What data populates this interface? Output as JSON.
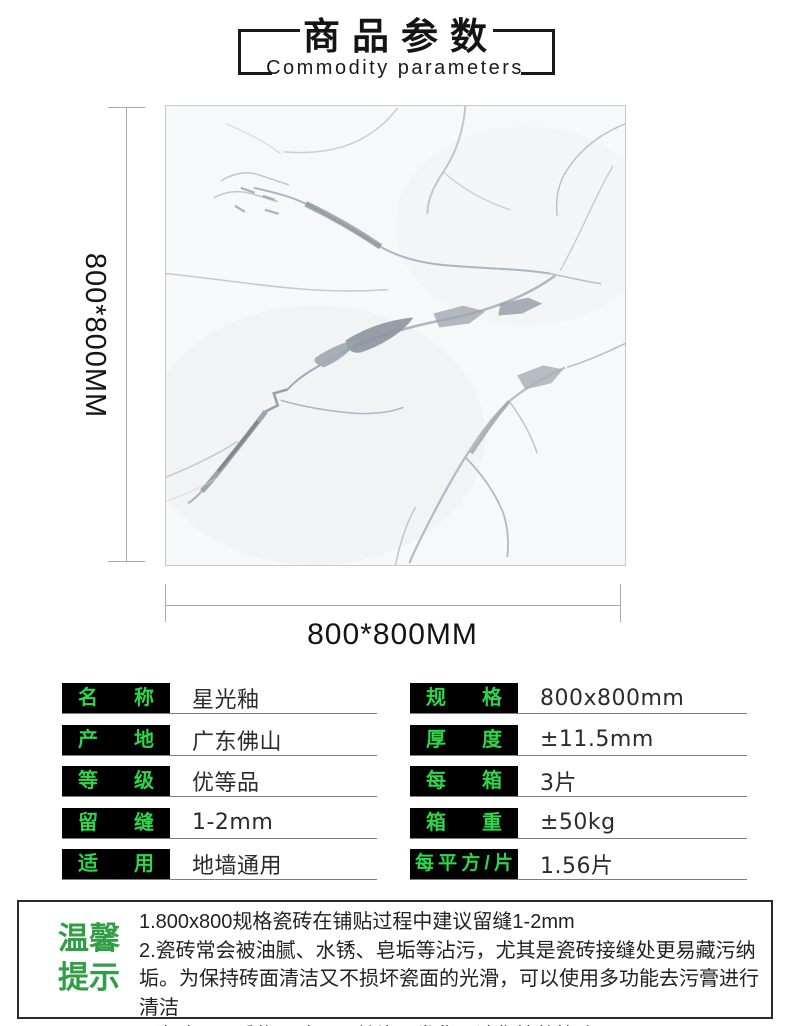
{
  "header": {
    "title": "商品参数",
    "subtitle": "Commodity parameters"
  },
  "figure": {
    "vertical_dimension": "800*800MM",
    "horizontal_dimension": "800*800MM",
    "tile_description": "white marble tile with gray veins"
  },
  "specs": {
    "left": [
      {
        "label": "名 称",
        "value": "星光釉"
      },
      {
        "label": "产 地",
        "value": "广东佛山"
      },
      {
        "label": "等 级",
        "value": "优等品"
      },
      {
        "label": "留 缝",
        "value": "1-2mm"
      },
      {
        "label": "适 用",
        "value": "地墙通用"
      }
    ],
    "right": [
      {
        "label": "规 格",
        "value": "800x800mm"
      },
      {
        "label": "厚 度",
        "value": "±11.5mm"
      },
      {
        "label": "每 箱",
        "value": "3片"
      },
      {
        "label": "箱 重",
        "value": "±50kg"
      },
      {
        "label": "每平方/片",
        "value": "1.56片"
      }
    ]
  },
  "tips": {
    "heading": [
      "温馨",
      "提示"
    ],
    "items": [
      "1.800x800规格瓷砖在铺贴过程中建议留缝1-2mm",
      "2.瓷砖常会被油腻、水锈、皂垢等沾污，尤其是瓷砖接缝处更易藏污纳垢。为保持砖面清洁又不损坏瓷面的光滑，可以使用多功能去污膏进行清洁",
      "3.瓷砖属于重物易碎品，单片不发货，请您按整箱购买"
    ]
  },
  "colors": {
    "label_green": "#2dd64a",
    "tip_green": "#2f9e44",
    "label_bg": "#000000"
  }
}
